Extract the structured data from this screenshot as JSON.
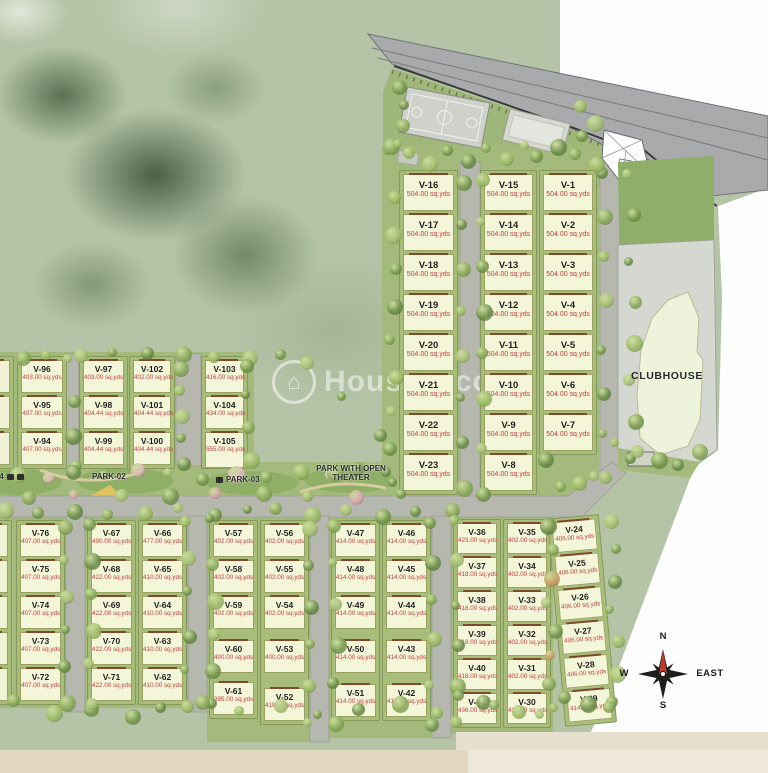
{
  "site": {
    "unit": "sq.yds",
    "watermark": "Housiey.com",
    "clubhouse": "CLUBHOUSE",
    "parks": {
      "p2": "PARK-02",
      "p3": "PARK-03",
      "p4": "PARK-04",
      "theater": "PARK WITH OPEN THEATER"
    },
    "compass": {
      "n": "N",
      "s": "S",
      "w": "W",
      "e": "EAST"
    },
    "columns": [
      {
        "b": "ne",
        "x": 399,
        "y": 170,
        "w": 59,
        "rowH": 40,
        "pH": 37,
        "plots": [
          {
            "id": "V-16",
            "area": "504.00"
          },
          {
            "id": "V-17",
            "area": "504.00"
          },
          {
            "id": "V-18",
            "area": "504.00"
          },
          {
            "id": "V-19",
            "area": "504.00"
          },
          {
            "id": "V-20",
            "area": "504.00"
          },
          {
            "id": "V-21",
            "area": "504.00"
          },
          {
            "id": "V-22",
            "area": "504.00"
          },
          {
            "id": "V-23",
            "area": "504.00"
          }
        ]
      },
      {
        "b": "ne",
        "x": 480,
        "y": 170,
        "w": 57,
        "rowH": 40,
        "pH": 37,
        "plots": [
          {
            "id": "V-15",
            "area": "504.00"
          },
          {
            "id": "V-14",
            "area": "504.00"
          },
          {
            "id": "V-13",
            "area": "504.00"
          },
          {
            "id": "V-12",
            "area": "504.00"
          },
          {
            "id": "V-11",
            "area": "504.00"
          },
          {
            "id": "V-10",
            "area": "504.00"
          },
          {
            "id": "V-9",
            "area": "504.00"
          },
          {
            "id": "V-8",
            "area": "504.00"
          }
        ]
      },
      {
        "b": "ne",
        "x": 539,
        "y": 170,
        "w": 58,
        "rowH": 40,
        "pH": 37,
        "plots": [
          {
            "id": "V-1",
            "area": "504.00"
          },
          {
            "id": "V-2",
            "area": "504.00"
          },
          {
            "id": "V-3",
            "area": "504.00"
          },
          {
            "id": "V-4",
            "area": "504.00"
          },
          {
            "id": "V-5",
            "area": "504.00"
          },
          {
            "id": "V-6",
            "area": "504.00"
          },
          {
            "id": "V-7",
            "area": "504.00"
          }
        ]
      },
      {
        "b": "ml",
        "x": -30,
        "y": 356,
        "w": 44,
        "rowH": 36,
        "pH": 33,
        "plots": [
          {},
          {},
          {}
        ]
      },
      {
        "b": "ml",
        "x": 17,
        "y": 356,
        "w": 50,
        "rowH": 36,
        "pH": 33,
        "plots": [
          {
            "id": "V-96",
            "area": "403.00"
          },
          {
            "id": "V-95",
            "area": "407.00"
          },
          {
            "id": "V-94",
            "area": "407.00"
          }
        ]
      },
      {
        "b": "ml",
        "x": 79,
        "y": 356,
        "w": 49,
        "rowH": 36,
        "pH": 33,
        "plots": [
          {
            "id": "V-97",
            "area": "403.00"
          },
          {
            "id": "V-98",
            "area": "404.44"
          },
          {
            "id": "V-99",
            "area": "404.44"
          }
        ]
      },
      {
        "b": "ml",
        "x": 129,
        "y": 356,
        "w": 46,
        "rowH": 36,
        "pH": 33,
        "plots": [
          {
            "id": "V-102",
            "area": "402.00"
          },
          {
            "id": "V-101",
            "area": "404.44"
          },
          {
            "id": "V-100",
            "area": "404.44"
          }
        ]
      },
      {
        "b": "ml",
        "x": 201,
        "y": 356,
        "w": 47,
        "rowH": 36,
        "pH": 33,
        "plots": [
          {
            "id": "V-103",
            "area": "416.00"
          },
          {
            "id": "V-104",
            "area": "434.00"
          },
          {
            "id": "V-105",
            "area": "555.00",
            "h": 36
          }
        ]
      },
      {
        "b": "sw",
        "x": -34,
        "y": 520,
        "w": 46,
        "rowH": 36,
        "pH": 33,
        "plots": [
          {},
          {},
          {},
          {},
          {}
        ]
      },
      {
        "b": "sw",
        "x": 16,
        "y": 520,
        "w": 49,
        "rowH": 36,
        "pH": 33,
        "plots": [
          {
            "id": "V-76",
            "area": "407.00"
          },
          {
            "id": "V-75",
            "area": "407.00"
          },
          {
            "id": "V-74",
            "area": "407.00"
          },
          {
            "id": "V-73",
            "area": "407.00"
          },
          {
            "id": "V-72",
            "area": "407.00"
          }
        ]
      },
      {
        "b": "sw",
        "x": 87,
        "y": 520,
        "w": 49,
        "rowH": 36,
        "pH": 33,
        "plots": [
          {
            "id": "V-67",
            "area": "490.00"
          },
          {
            "id": "V-68",
            "area": "422.00"
          },
          {
            "id": "V-69",
            "area": "422.00"
          },
          {
            "id": "V-70",
            "area": "422.00"
          },
          {
            "id": "V-71",
            "area": "422.00"
          }
        ]
      },
      {
        "b": "sw",
        "x": 138,
        "y": 520,
        "w": 49,
        "rowH": 36,
        "pH": 33,
        "plots": [
          {
            "id": "V-66",
            "area": "477.00"
          },
          {
            "id": "V-65",
            "area": "410.00"
          },
          {
            "id": "V-64",
            "area": "410.00"
          },
          {
            "id": "V-63",
            "area": "410.00"
          },
          {
            "id": "V-62",
            "area": "410.00"
          }
        ]
      },
      {
        "b": "sw",
        "x": 209,
        "y": 520,
        "w": 49,
        "rowH": 36,
        "pH": 33,
        "plots": [
          {
            "id": "V-57",
            "area": "402.00"
          },
          {
            "id": "V-58",
            "area": "402.00"
          },
          {
            "id": "V-59",
            "area": "402.00"
          },
          {
            "id": "V-60",
            "area": "400.00",
            "dy": 8
          },
          {
            "id": "V-61",
            "area": "395.00",
            "dy": 14
          }
        ]
      },
      {
        "b": "sw",
        "x": 260,
        "y": 520,
        "w": 49,
        "rowH": 36,
        "pH": 33,
        "plots": [
          {
            "id": "V-56",
            "area": "402.00"
          },
          {
            "id": "V-55",
            "area": "402.00"
          },
          {
            "id": "V-54",
            "area": "402.00"
          },
          {
            "id": "V-53",
            "area": "400.00",
            "dy": 8
          },
          {
            "id": "V-52",
            "area": "418.00",
            "dy": 20
          }
        ]
      },
      {
        "b": "sw",
        "x": 331,
        "y": 520,
        "w": 49,
        "rowH": 36,
        "pH": 33,
        "plots": [
          {
            "id": "V-47",
            "area": "414.00"
          },
          {
            "id": "V-48",
            "area": "414.00"
          },
          {
            "id": "V-49",
            "area": "414.00"
          },
          {
            "id": "V-50",
            "area": "414.00",
            "dy": 8
          },
          {
            "id": "V-51",
            "area": "414.00",
            "dy": 16
          }
        ]
      },
      {
        "b": "sw",
        "x": 382,
        "y": 520,
        "w": 49,
        "rowH": 36,
        "pH": 33,
        "plots": [
          {
            "id": "V-46",
            "area": "414.00"
          },
          {
            "id": "V-45",
            "area": "414.00"
          },
          {
            "id": "V-44",
            "area": "414.00"
          },
          {
            "id": "V-43",
            "area": "414.00",
            "dy": 8
          },
          {
            "id": "V-42",
            "area": "414.00",
            "dy": 16
          }
        ]
      },
      {
        "b": "sw",
        "x": 453,
        "y": 519,
        "w": 48,
        "rowH": 34,
        "pH": 31,
        "plots": [
          {
            "id": "V-36",
            "area": "423.00"
          },
          {
            "id": "V-37",
            "area": "418.00"
          },
          {
            "id": "V-38",
            "area": "418.00"
          },
          {
            "id": "V-39",
            "area": "418.00"
          },
          {
            "id": "V-40",
            "area": "418.00"
          },
          {
            "id": "V-41",
            "area": "436.00"
          }
        ]
      },
      {
        "b": "sw",
        "x": 503,
        "y": 519,
        "w": 48,
        "rowH": 34,
        "pH": 31,
        "plots": [
          {
            "id": "V-35",
            "area": "402.00"
          },
          {
            "id": "V-34",
            "area": "402.00"
          },
          {
            "id": "V-33",
            "area": "402.00"
          },
          {
            "id": "V-32",
            "area": "402.00"
          },
          {
            "id": "V-31",
            "area": "402.00"
          },
          {
            "id": "V-30",
            "area": "414.00"
          }
        ]
      },
      {
        "b": "sw",
        "x": 556,
        "y": 516,
        "w": 52,
        "rowH": 34,
        "pH": 31,
        "rot": -5,
        "plots": [
          {
            "id": "V-24",
            "area": "406.00"
          },
          {
            "id": "V-25",
            "area": "406.00"
          },
          {
            "id": "V-26",
            "area": "406.00"
          },
          {
            "id": "V-27",
            "area": "406.00"
          },
          {
            "id": "V-28",
            "area": "406.00"
          },
          {
            "id": "V-29",
            "area": "414.00"
          }
        ]
      }
    ]
  }
}
